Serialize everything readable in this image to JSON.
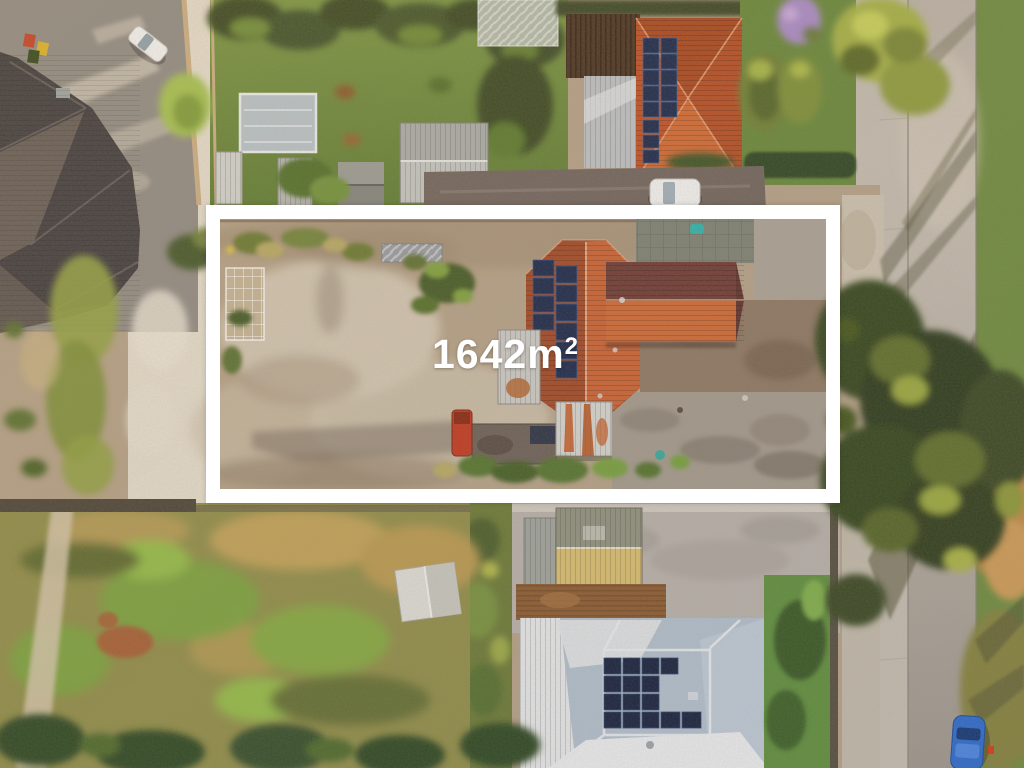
{
  "annotation": {
    "full_label": "1642m²",
    "area_base": "1642m",
    "area_sup": "2"
  },
  "colors": {
    "boundary": "#ffffff",
    "label_text": "#ffffff",
    "sand": "#cdc1a9",
    "sand_light": "#e2dbc9",
    "dirt": "#b3a186",
    "dirt_dark": "#8d7962",
    "asphalt": "#8f8b83",
    "asphalt_dark": "#70655c",
    "roof_charcoal": "#403e3f",
    "roof_orange": "#bd5226",
    "roof_orange_bright": "#d06a33",
    "roof_maroon": "#6e3c34",
    "roof_red_main": "#b0512a",
    "solar_panel": "#1c2a4a",
    "shed_white": "#d3d3cd",
    "shed_gray": "#a9aca6",
    "rust": "#c1581e",
    "shed_yellow": "#d6bd6e",
    "roof_white_metal": "#e3e5e3",
    "roof_blue_gray": "#b0bfca",
    "grass": "#6b8a3c",
    "grass_dark": "#3a4a24",
    "grass_bright": "#8fb944",
    "field_olive": "#8f8d48",
    "field_tan": "#bfa257",
    "tree_dark": "#36461f",
    "tree_yellow": "#9aa83e",
    "hedge": "#2f4722",
    "road": "#aba49a",
    "footpath": "#c3bcae",
    "concrete": "#b6b1a8",
    "car_white": "#f0f1ef",
    "car_blue": "#2f6cc9",
    "teal_object": "#2fb3ab",
    "red_object": "#bf3a20",
    "purple_tree": "#a98bc4"
  }
}
